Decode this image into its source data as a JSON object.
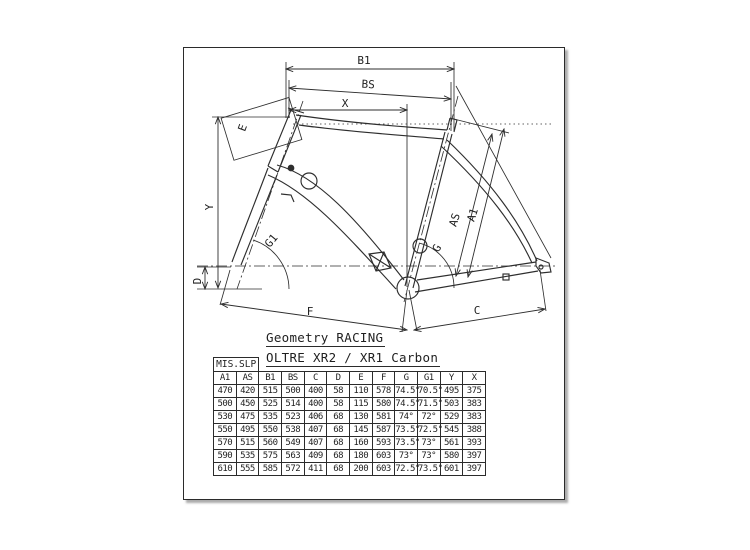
{
  "titles": {
    "geometry": "Geometry RACING",
    "model": "OLTRE XR2 / XR1 Carbon"
  },
  "diagram": {
    "labels": {
      "b1": "B1",
      "bs": "BS",
      "x": "X",
      "e": "E",
      "y": "Y",
      "g1": "G1",
      "d": "D",
      "f": "F",
      "c": "C",
      "g": "G",
      "as": "AS",
      "a1": "A1"
    }
  },
  "table": {
    "corner_label": "MIS.SLP",
    "columns": [
      "A1",
      "AS",
      "B1",
      "BS",
      "C",
      "D",
      "E",
      "F",
      "G",
      "G1",
      "Y",
      "X"
    ],
    "rows": [
      [
        "470",
        "420",
        "515",
        "500",
        "400",
        "58",
        "110",
        "578",
        "74.5°",
        "70.5°",
        "495",
        "375"
      ],
      [
        "500",
        "450",
        "525",
        "514",
        "400",
        "58",
        "115",
        "580",
        "74.5°",
        "71.5°",
        "503",
        "383"
      ],
      [
        "530",
        "475",
        "535",
        "523",
        "406",
        "68",
        "130",
        "581",
        "74°",
        "72°",
        "529",
        "383"
      ],
      [
        "550",
        "495",
        "550",
        "538",
        "407",
        "68",
        "145",
        "587",
        "73.5°",
        "72.5°",
        "545",
        "388"
      ],
      [
        "570",
        "515",
        "560",
        "549",
        "407",
        "68",
        "160",
        "593",
        "73.5°",
        "73°",
        "561",
        "393"
      ],
      [
        "590",
        "535",
        "575",
        "563",
        "409",
        "68",
        "180",
        "603",
        "73°",
        "73°",
        "580",
        "397"
      ],
      [
        "610",
        "555",
        "585",
        "572",
        "411",
        "68",
        "200",
        "603",
        "72.5°",
        "73.5°",
        "601",
        "397"
      ]
    ]
  },
  "colors": {
    "ink": "#2e2e2e",
    "paper": "#ffffff"
  }
}
